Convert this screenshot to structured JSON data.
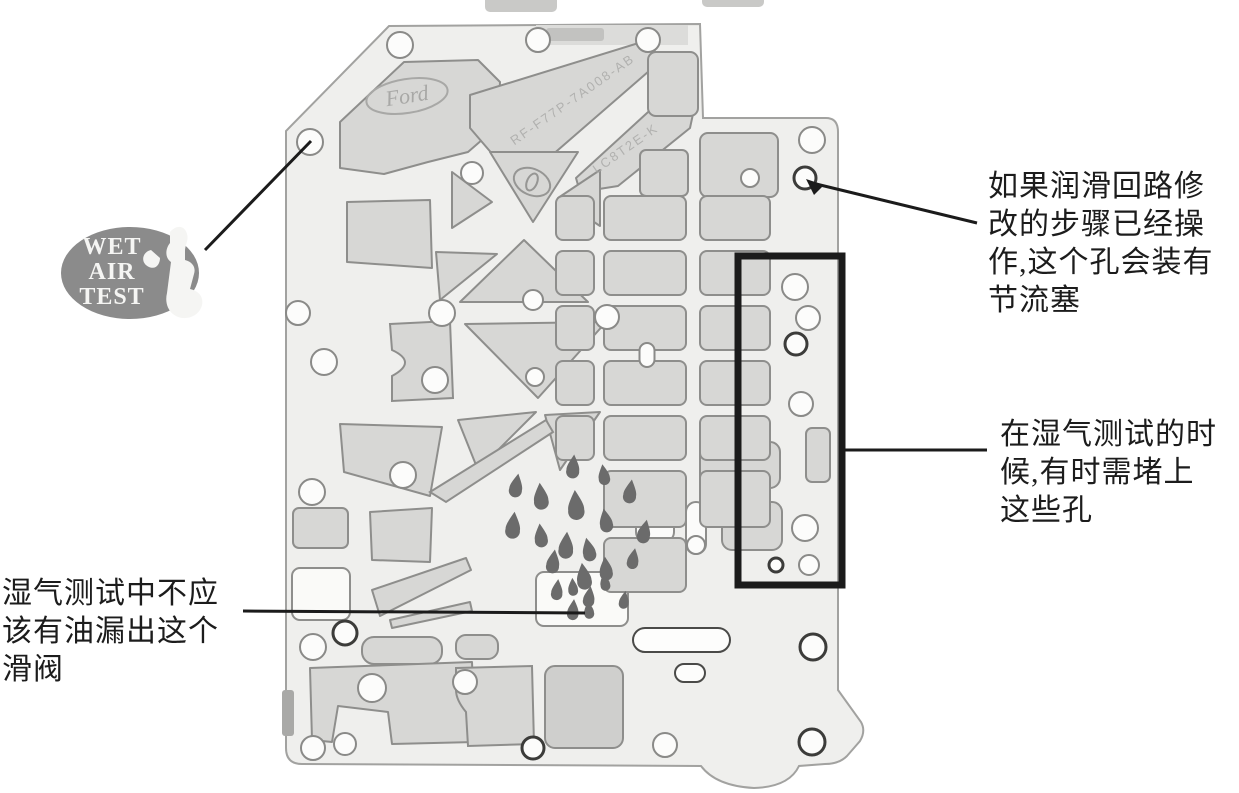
{
  "figure": {
    "title": "valve-body-separator-plate-wet-air-test-diagram",
    "colors": {
      "background": "#ffffff",
      "plate_fill": "#efefed",
      "plate_stroke": "#a2a2a0",
      "pocket_fill": "#d7d7d5",
      "pocket_stroke": "#8e8e8c",
      "hole_fill": "#fcfcfb",
      "hole_stroke": "#8a8a88",
      "hole_dark_stroke": "#3c3c3a",
      "drop_fill": "#6b6b6b",
      "badge_fill": "#8b8b8b",
      "badge_text": "#f5f5f3",
      "annotation_ink": "#1b1b1b",
      "stamp_ink": "#a8a8a6"
    },
    "badge": {
      "lines": [
        "WET",
        "AIR",
        "TEST"
      ],
      "cx": 130,
      "cy": 273,
      "rx": 69,
      "ry": 46,
      "text_x": 112,
      "line_ys": [
        254,
        279,
        304
      ],
      "font_size": 24,
      "silhouette_d": "M170,232 c7,-8 15,-6 17,2 c2,6 -2,11 -2,17 l0,9 c8,2 11,8 9,14 l-4,15 c10,2 15,10 11,19 c-5,11 -20,13 -28,6 c-6,-5 -8,-13 -6,-21 l4,-31 c-6,-4 -6,-13 -1,-19 Z M151,250 c-9,2 -11,13 -2,17 c7,3 11,-3 11,-9 Z"
    },
    "annotations": {
      "right_top": {
        "left": 988,
        "top": 168,
        "lines": [
          "如果润滑回路修",
          "改的步骤已经操",
          "作,这个孔会装有",
          "节流塞"
        ]
      },
      "right_mid": {
        "left": 1000,
        "top": 416,
        "lines": [
          "在湿气测试的时",
          "候,有时需堵上",
          "这些孔"
        ]
      },
      "bottom_left": {
        "left": 2,
        "top": 575,
        "lines": [
          "湿气测试中不应",
          "该有油漏出这个",
          "滑阀"
        ]
      }
    },
    "stamps": {
      "logo_text": "Ford",
      "logo": {
        "cx": 407,
        "cy": 96,
        "rx": 41,
        "ry": 17,
        "rotate": -9
      },
      "code1": "RF-F77P-7A008-AB",
      "code1_pos": {
        "x": 575,
        "y": 103,
        "rotate": -35
      },
      "code2": "LC8T2E-K",
      "code2_pos": {
        "x": 628,
        "y": 152,
        "rotate": -35
      }
    },
    "plate": {
      "outline_d": "M389,26 L700,24 L703,118 L826,118 Q838,118 838,132 L838,690 L861,722 Q866,731 860,741 L847,756 Q839,764 825,764 L799,766 Q789,787 754,788 Q716,786 701,766 L302,764 Q286,764 286,748 L286,131 Z",
      "edge_notch": {
        "x": 282,
        "y": 690,
        "w": 12,
        "h": 46,
        "fill": "#a9a9a7"
      },
      "artifacts": [
        [
          485,
          -6,
          72,
          18
        ],
        [
          702,
          -5,
          62,
          12
        ]
      ],
      "top_tab": {
        "x": 536,
        "y": 25,
        "w": 152,
        "h": 20
      },
      "pockets": [
        {
          "poly": "340,168 340,122 404,62 478,60 500,82 498,126 468,152 428,162 384,174"
        },
        {
          "poly": "470,95 642,42 664,58 543,163 500,163 470,128"
        },
        {
          "poly": "576,178 670,92 696,100 690,128 618,186 580,192"
        },
        {
          "rect": [
            648,
            52,
            50,
            64,
            8
          ]
        },
        {
          "rect": [
            700,
            133,
            78,
            64,
            8
          ]
        },
        {
          "rect": [
            640,
            150,
            48,
            46,
            6
          ]
        },
        {
          "poly": "347,202 430,200 432,268 347,262"
        },
        {
          "d": "M390,324 L450,321 L453,398 L392,401 L392,376 Q418,362 392,350 Z"
        },
        {
          "poly": "340,424 442,427 430,496 344,472"
        },
        {
          "rect": [
            293,
            508,
            55,
            40,
            6
          ]
        },
        {
          "poly": "370,512 432,508 430,562 372,560"
        },
        {
          "rect": [
            292,
            568,
            58,
            52,
            8
          ],
          "fill": "#fafaf8"
        },
        {
          "poly": "372,590 466,558 471,570 380,616"
        },
        {
          "poly": "390,620 470,602 472,611 392,628"
        },
        {
          "rect": [
            362,
            637,
            80,
            27,
            12
          ]
        },
        {
          "rect": [
            456,
            635,
            42,
            24,
            10
          ]
        },
        {
          "poly": "310,668 472,662 475,742 392,744 388,712 338,706 332,742 312,740"
        },
        {
          "d": "M456,668 L532,666 L534,744 L468,746 L466,712 Q456,700 456,690 Z"
        },
        {
          "rect": [
            545,
            666,
            78,
            82,
            10
          ],
          "fill": "#cfcfcd"
        },
        {
          "rect": [
            633,
            628,
            97,
            24,
            12
          ],
          "fill": "#fdfdfc",
          "stroke": "#4a4a48"
        },
        {
          "rect": [
            675,
            664,
            30,
            18,
            9
          ],
          "fill": "#fdfdfc",
          "stroke": "#4a4a48"
        },
        {
          "rect": [
            806,
            428,
            24,
            54,
            6
          ]
        },
        {
          "poly": "490,152 578,152 533,222"
        },
        {
          "poly": "452,172 492,202 452,228"
        },
        {
          "poly": "600,170 558,198 600,226"
        },
        {
          "poly": "460,302 524,240 588,302"
        },
        {
          "poly": "465,324 606,322 538,398"
        },
        {
          "poly": "545,415 600,412 560,470"
        },
        {
          "poly": "458,420 536,412 478,470"
        },
        {
          "d": "M430,492 L546,420 L553,432 L446,502 Z"
        },
        {
          "poly": "436,252 497,254 440,300"
        },
        {
          "rect": [
            536,
            572,
            92,
            54,
            8
          ],
          "fill": "#fafaf8"
        },
        {
          "rect": [
            636,
            486,
            38,
            56,
            10
          ],
          "fill": "#fbfbfa"
        },
        {
          "rect": [
            686,
            502,
            20,
            52,
            10
          ],
          "fill": "#fbfbfa"
        },
        {
          "rect": [
            722,
            502,
            60,
            48,
            10
          ]
        },
        {
          "rect": [
            700,
            442,
            80,
            46,
            10
          ]
        }
      ],
      "grid": {
        "cols": [
          [
            556,
            38,
            0,
            4
          ],
          [
            604,
            82,
            0,
            6
          ],
          [
            700,
            70,
            0,
            5
          ]
        ],
        "rows": [
          [
            196,
            44
          ],
          [
            251,
            44
          ],
          [
            306,
            44
          ],
          [
            361,
            44
          ],
          [
            416,
            44
          ],
          [
            471,
            56
          ],
          [
            538,
            54
          ]
        ]
      },
      "holes": [
        [
          400,
          45,
          13
        ],
        [
          538,
          40,
          12
        ],
        [
          648,
          40,
          12
        ],
        [
          812,
          140,
          13
        ],
        [
          805,
          178,
          11,
          1
        ],
        [
          310,
          142,
          13
        ],
        [
          298,
          313,
          12
        ],
        [
          324,
          362,
          13
        ],
        [
          312,
          492,
          13
        ],
        [
          435,
          380,
          13
        ],
        [
          403,
          475,
          13
        ],
        [
          472,
          173,
          11
        ],
        [
          442,
          313,
          13
        ],
        [
          607,
          317,
          12
        ],
        [
          533,
          300,
          10
        ],
        [
          535,
          377,
          9
        ],
        [
          750,
          178,
          9
        ],
        [
          372,
          688,
          14
        ],
        [
          465,
          682,
          12
        ],
        [
          313,
          647,
          13
        ],
        [
          345,
          633,
          12,
          1
        ],
        [
          313,
          748,
          12
        ],
        [
          345,
          744,
          11
        ],
        [
          533,
          748,
          11,
          1
        ],
        [
          795,
          287,
          13
        ],
        [
          808,
          318,
          12
        ],
        [
          796,
          344,
          11,
          1
        ],
        [
          801,
          404,
          12
        ],
        [
          805,
          528,
          13
        ],
        [
          809,
          565,
          10
        ],
        [
          776,
          565,
          7,
          1
        ],
        [
          813,
          647,
          13,
          1
        ],
        [
          665,
          745,
          12
        ],
        [
          812,
          742,
          13,
          1
        ],
        [
          696,
          545,
          9
        ]
      ],
      "pills": [
        [
          647,
          355,
          15,
          24
        ]
      ],
      "oval_stamp": {
        "cx": 532,
        "cy": 182,
        "rx": 19,
        "ry": 13,
        "rotate": 24
      },
      "drops": [
        [
          573,
          468,
          8,
          5
        ],
        [
          604,
          476,
          7,
          -8
        ],
        [
          516,
          487,
          8,
          10
        ],
        [
          541,
          498,
          9,
          -5
        ],
        [
          630,
          493,
          8,
          8
        ],
        [
          576,
          507,
          10,
          -4
        ],
        [
          513,
          527,
          9,
          6
        ],
        [
          606,
          522,
          8,
          -10
        ],
        [
          644,
          533,
          8,
          12
        ],
        [
          541,
          537,
          8,
          -6
        ],
        [
          566,
          547,
          9,
          4
        ],
        [
          589,
          551,
          8,
          -12
        ],
        [
          553,
          563,
          8,
          8
        ],
        [
          606,
          570,
          8,
          -5
        ],
        [
          633,
          560,
          7,
          10
        ],
        [
          584,
          578,
          9,
          -8
        ],
        [
          557,
          591,
          7,
          6
        ],
        [
          573,
          588,
          6,
          -4
        ],
        [
          589,
          598,
          7,
          8
        ],
        [
          605,
          583,
          6,
          -10
        ],
        [
          573,
          611,
          7,
          5
        ],
        [
          589,
          611,
          6,
          -6
        ],
        [
          624,
          601,
          6,
          8
        ]
      ],
      "highlight_rect": {
        "x": 738,
        "y": 256,
        "w": 104,
        "h": 329,
        "stroke_width": 7
      },
      "callout_lines": [
        [
          205,
          250,
          311,
          141
        ],
        [
          812,
          183,
          977,
          223
        ],
        [
          843,
          450,
          987,
          450
        ],
        [
          243,
          611,
          585,
          613
        ]
      ],
      "arrowhead_points": "806,179 824,185 814,195"
    }
  }
}
